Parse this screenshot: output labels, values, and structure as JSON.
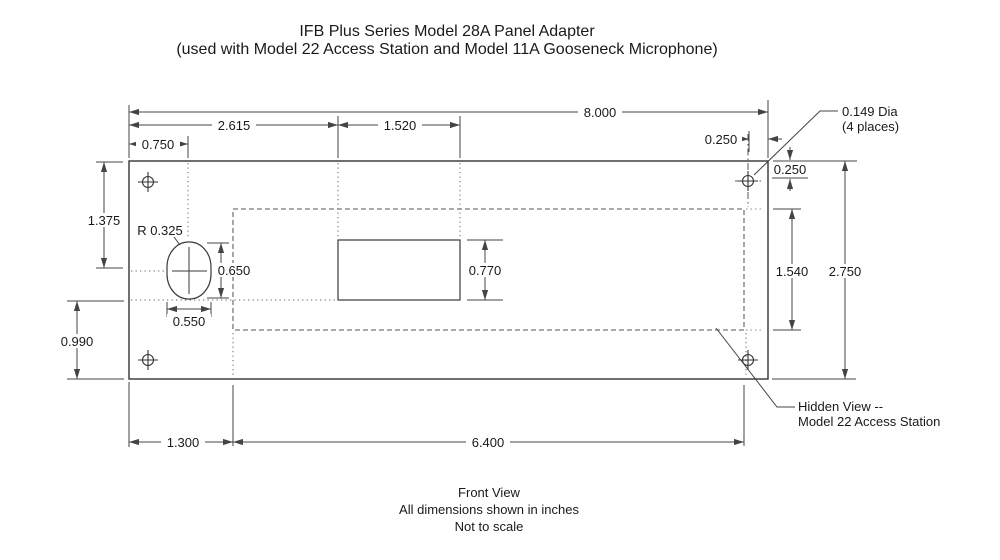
{
  "title": {
    "line1": "IFB Plus Series Model 28A Panel Adapter",
    "line2": "(used with Model 22 Access Station and Model 11A Gooseneck Microphone)"
  },
  "footer": {
    "view": "Front View",
    "units": "All dimensions shown in inches",
    "scale": "Not to scale"
  },
  "dimensions": {
    "panel_width": "8.000",
    "cutout_from_left": "2.615",
    "cutout_width": "1.520",
    "hole_offset_left": "0.750",
    "hole_offset_right": "0.250",
    "hole_offset_top": "0.250",
    "panel_height": "2.750",
    "pocket_height": "1.540",
    "pocket_width": "6.400",
    "pocket_from_left": "1.300",
    "slot_center_from_top": "1.375",
    "ref_from_bottom": "0.990",
    "slot_height": "0.650",
    "slot_width": "0.550",
    "cutout_height": "0.770",
    "slot_radius": "R 0.325"
  },
  "annotations": {
    "hole_dia": {
      "line1": "0.149 Dia",
      "line2": "(4 places)"
    },
    "hidden_view": {
      "line1": "Hidden View --",
      "line2": "Model 22 Access Station"
    }
  },
  "colors": {
    "background": "#ffffff",
    "line": "#3a3a3a",
    "dim": "#444444",
    "hidden_line": "#8f8f8f",
    "construction": "#666666",
    "text": "#1a1a1a"
  }
}
